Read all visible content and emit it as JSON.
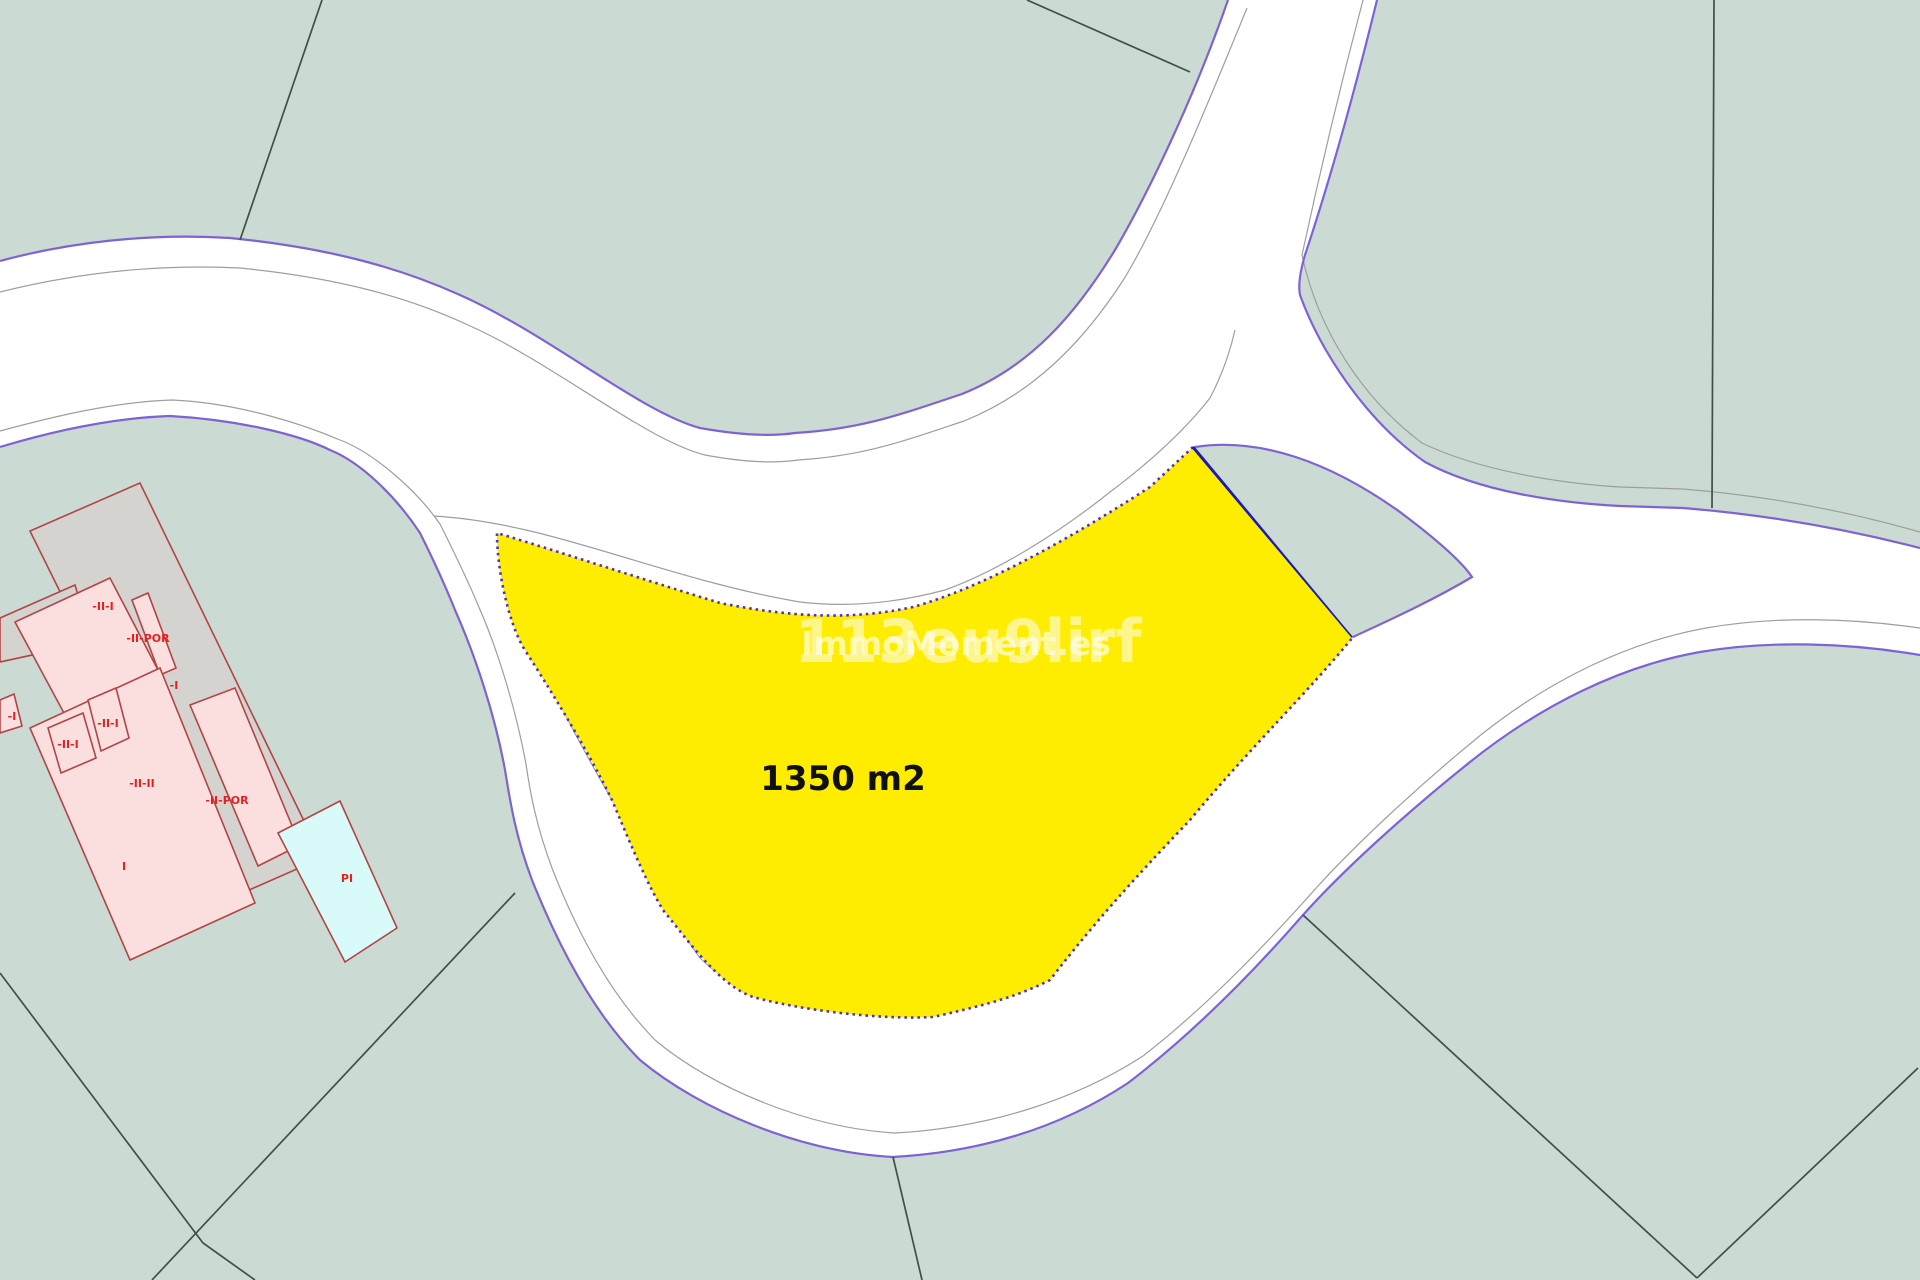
{
  "map": {
    "plot": {
      "area_label": "1350 m2"
    },
    "watermark": {
      "large": "113eu9lirf",
      "small": "ImmoMoment.es"
    },
    "building_labels": [
      {
        "text": "-II-I",
        "x": 103,
        "y": 610
      },
      {
        "text": "-II-POR",
        "x": 148,
        "y": 642
      },
      {
        "text": "-I",
        "x": 174,
        "y": 689
      },
      {
        "text": "-I",
        "x": 12,
        "y": 720
      },
      {
        "text": "-II-I",
        "x": 108,
        "y": 727
      },
      {
        "text": "-II-I",
        "x": 68,
        "y": 748
      },
      {
        "text": "-II-II",
        "x": 142,
        "y": 787
      },
      {
        "text": "-II-POR",
        "x": 227,
        "y": 804
      },
      {
        "text": "I",
        "x": 124,
        "y": 870
      },
      {
        "text": "PI",
        "x": 347,
        "y": 882
      }
    ],
    "colors": {
      "background": "#cbdbd3",
      "road": "#ffffff",
      "road_border": "#7e63d2",
      "curb": "#9e9e9e",
      "parcel_line": "#3f5147",
      "plot_fill": "#feed00",
      "plot_border": "#4b2fc9",
      "plot_divider": "#1b1bb3",
      "bldg_gray": "#d5d3d0",
      "bldg_pink": "#fbdede",
      "bldg_outline": "#b04545",
      "pool": "#d8fbfa",
      "label_red": "#e22222",
      "watermark": "#ffffff"
    }
  }
}
